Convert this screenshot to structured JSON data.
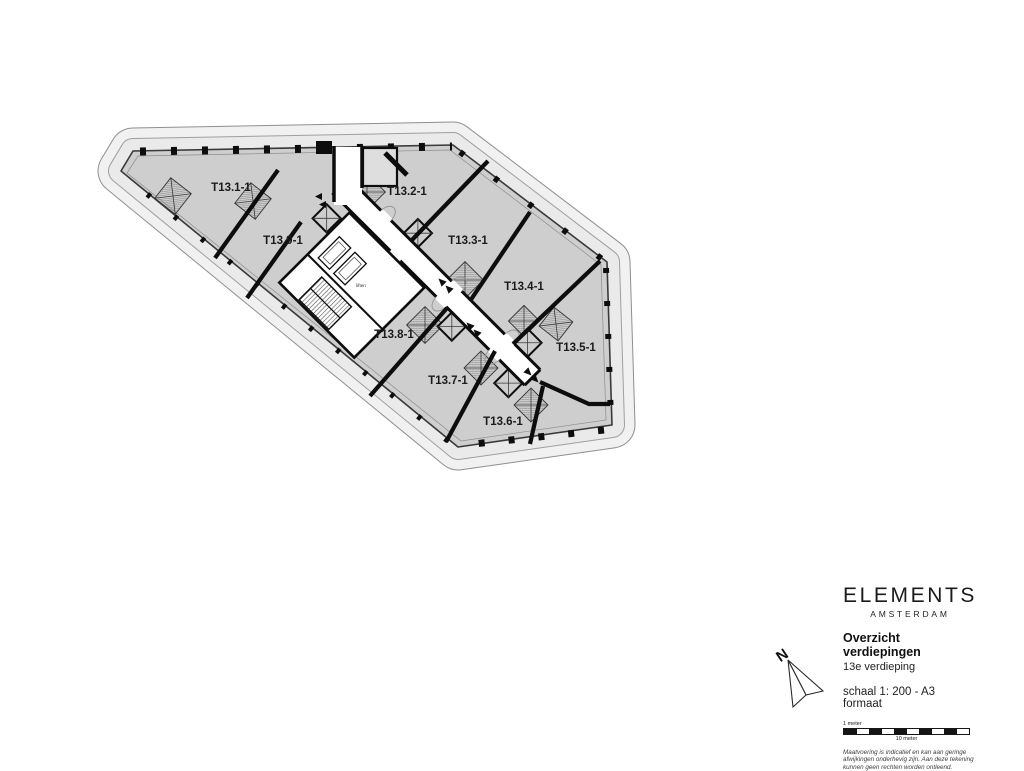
{
  "plan": {
    "units": [
      {
        "id": "T13.1-1"
      },
      {
        "id": "T13.2-1"
      },
      {
        "id": "T13.3-1"
      },
      {
        "id": "T13.4-1"
      },
      {
        "id": "T13.5-1"
      },
      {
        "id": "T13.6-1"
      },
      {
        "id": "T13.7-1"
      },
      {
        "id": "T13.8-1"
      },
      {
        "id": "T13.9-1"
      }
    ],
    "core_label": "liften"
  },
  "compass": {
    "label": "N"
  },
  "titleblock": {
    "brand": "ELEMENTS",
    "brand_subtitle": "AMSTERDAM",
    "title": "Overzicht verdiepingen",
    "floor": "13e verdieping",
    "scale": "schaal 1: 200 - A3 formaat",
    "scalebar": {
      "top_label": "1 meter",
      "bottom_label": "10 meter"
    },
    "disclaimer": [
      "Maatvoering is indicatief en kan aan geringe",
      "afwijkingen onderhevig zijn. Aan deze tekening",
      "kunnen geen rechten worden ontleend."
    ]
  },
  "colors": {
    "floor": "#cecece",
    "terrace_band": "#f1f1f1",
    "terrace_band_inner": "#eaeaea",
    "wall": "#0d0d0d"
  }
}
